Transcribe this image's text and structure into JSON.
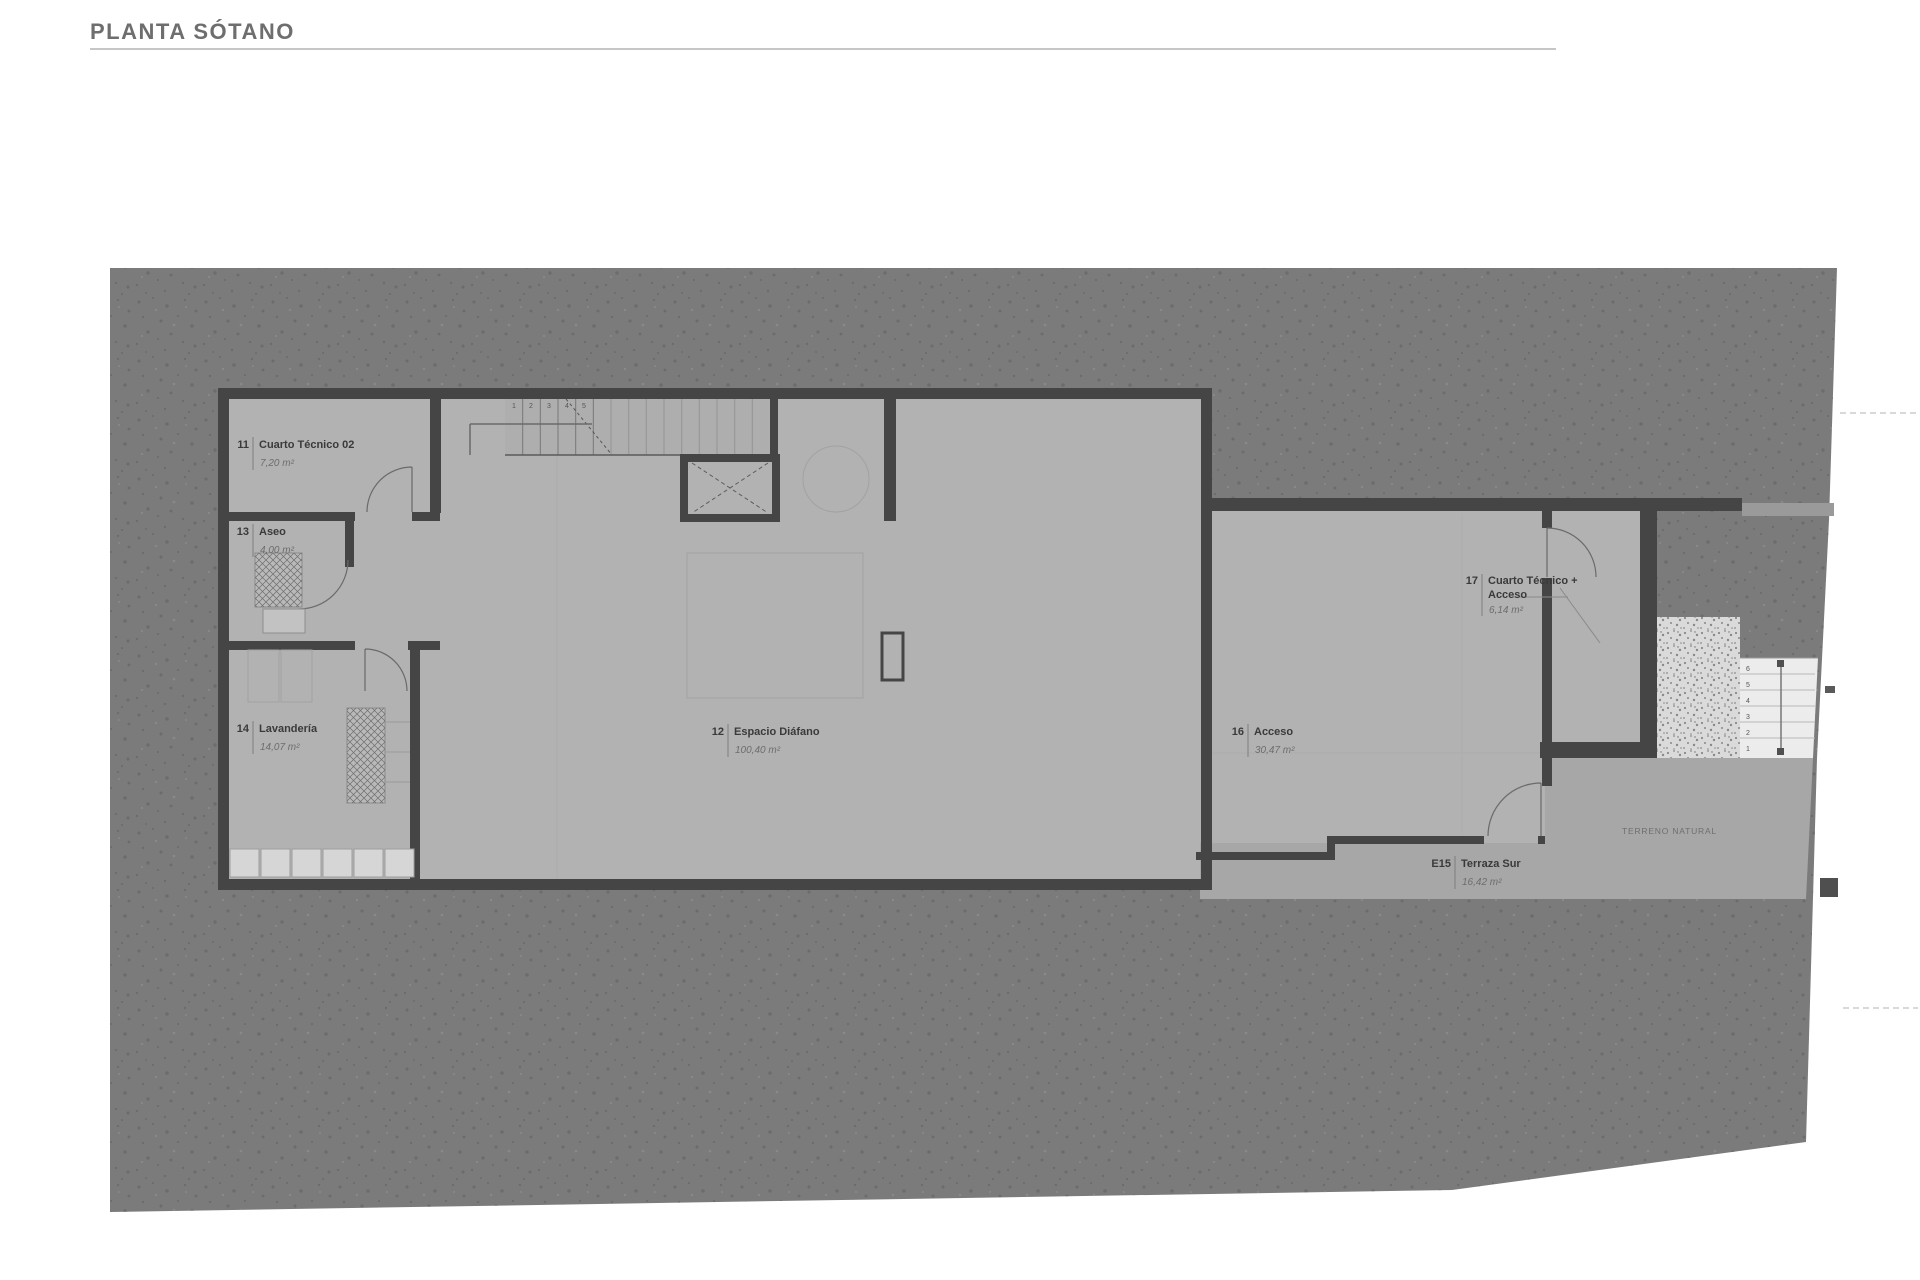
{
  "title": "PLANTA SÓTANO",
  "rooms": [
    {
      "number": "11",
      "name": "Cuarto Técnico 02",
      "area": "7,20 m²"
    },
    {
      "number": "13",
      "name": "Aseo",
      "area": "4,00 m²"
    },
    {
      "number": "14",
      "name": "Lavandería",
      "area": "14,07 m²"
    },
    {
      "number": "12",
      "name": "Espacio Diáfano",
      "area": "100,40 m²"
    },
    {
      "number": "16",
      "name": "Acceso",
      "area": "30,47 m²"
    },
    {
      "number": "17",
      "name_line1": "Cuarto Técnico +",
      "name_line2": "Acceso",
      "area": "6,14 m²"
    },
    {
      "number": "E15",
      "name": "Terraza Sur",
      "area": "16,42 m²"
    }
  ],
  "annotations": {
    "terrain_label": "TERRENO NATURAL"
  },
  "stairs": {
    "interior": [
      "1",
      "2",
      "3",
      "4",
      "5"
    ],
    "exterior": [
      "6",
      "5",
      "4",
      "3",
      "2",
      "1"
    ]
  },
  "colors": {
    "terrain": "#7b7b7b",
    "floor": "#b2b2b2",
    "wall": "#454545",
    "terrace": "#a7a7a7",
    "exterior_stair": "#ececec",
    "gravel": "#dadada",
    "title_text": "#6e6e6e"
  }
}
